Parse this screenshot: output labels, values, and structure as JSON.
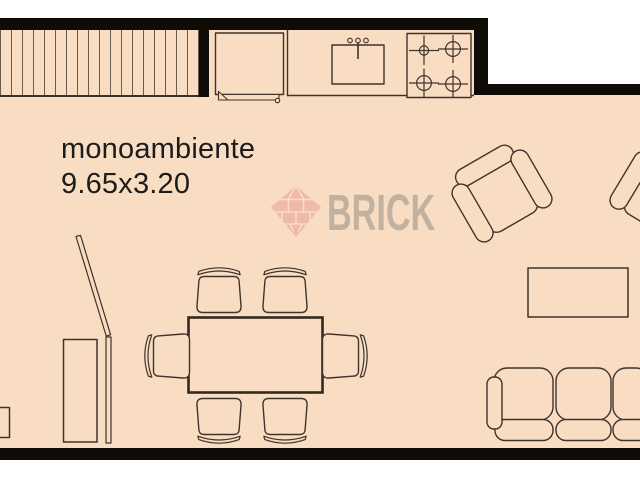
{
  "room": {
    "name": "monoambiente",
    "dimensions": "9.65x3.20"
  },
  "watermark": {
    "brand": "BRICK",
    "logo": "brick-diamond-logo"
  },
  "colors": {
    "floor": "#f8ddc3",
    "wall": "#0f0c08",
    "furniture_line": "#3f332a",
    "label_text": "#1c1c1c",
    "watermark_text": "#8b867f",
    "watermark_logo": "#eeb2a1"
  },
  "furniture": [
    "hatched closet strip",
    "kitchen counter",
    "sink with faucet",
    "stove with 4 burners",
    "fridge cabinet",
    "dining table",
    "dining chair x6",
    "armchair",
    "armchair partial",
    "coffee table",
    "three seat sofa",
    "wardrobe",
    "folding panel door",
    "side table"
  ]
}
